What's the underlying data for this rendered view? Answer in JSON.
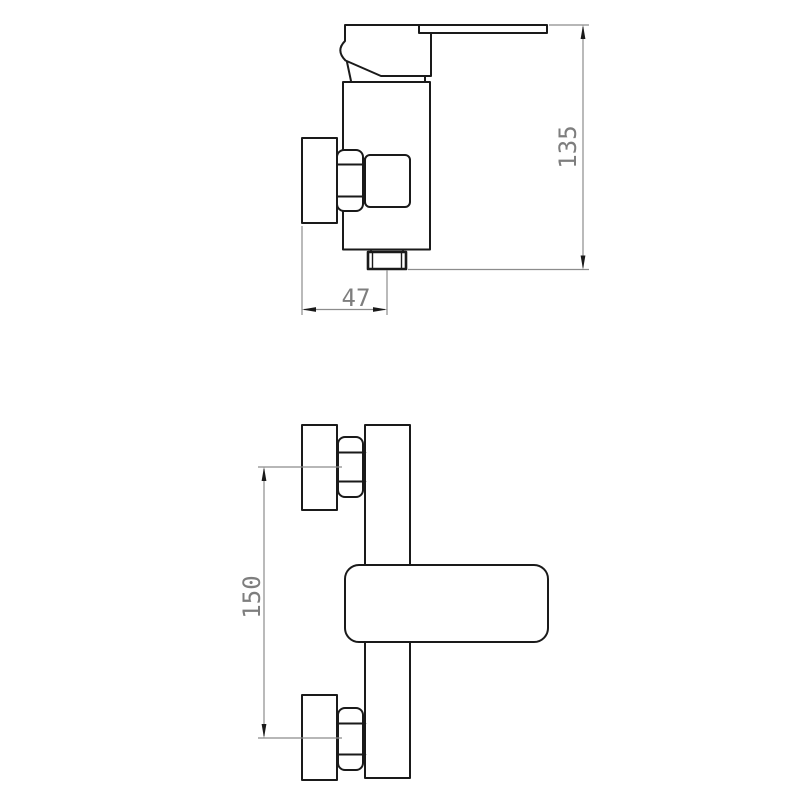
{
  "drawing": {
    "type": "technical-drawing",
    "subject": "wall-mounted single-lever shower mixer tap",
    "background": "#ffffff",
    "colors": {
      "outline": "#1a1a1a",
      "dimension_line": "#8c8c8c",
      "dimension_text": "#7e7e7e",
      "arrow": "#1a1a1a"
    },
    "views": [
      {
        "name": "side view",
        "dimensions": [
          {
            "value": "135",
            "orientation": "vertical"
          },
          {
            "value": "47",
            "orientation": "horizontal"
          }
        ]
      },
      {
        "name": "front view",
        "dimensions": [
          {
            "value": "150",
            "orientation": "vertical"
          }
        ]
      }
    ]
  }
}
